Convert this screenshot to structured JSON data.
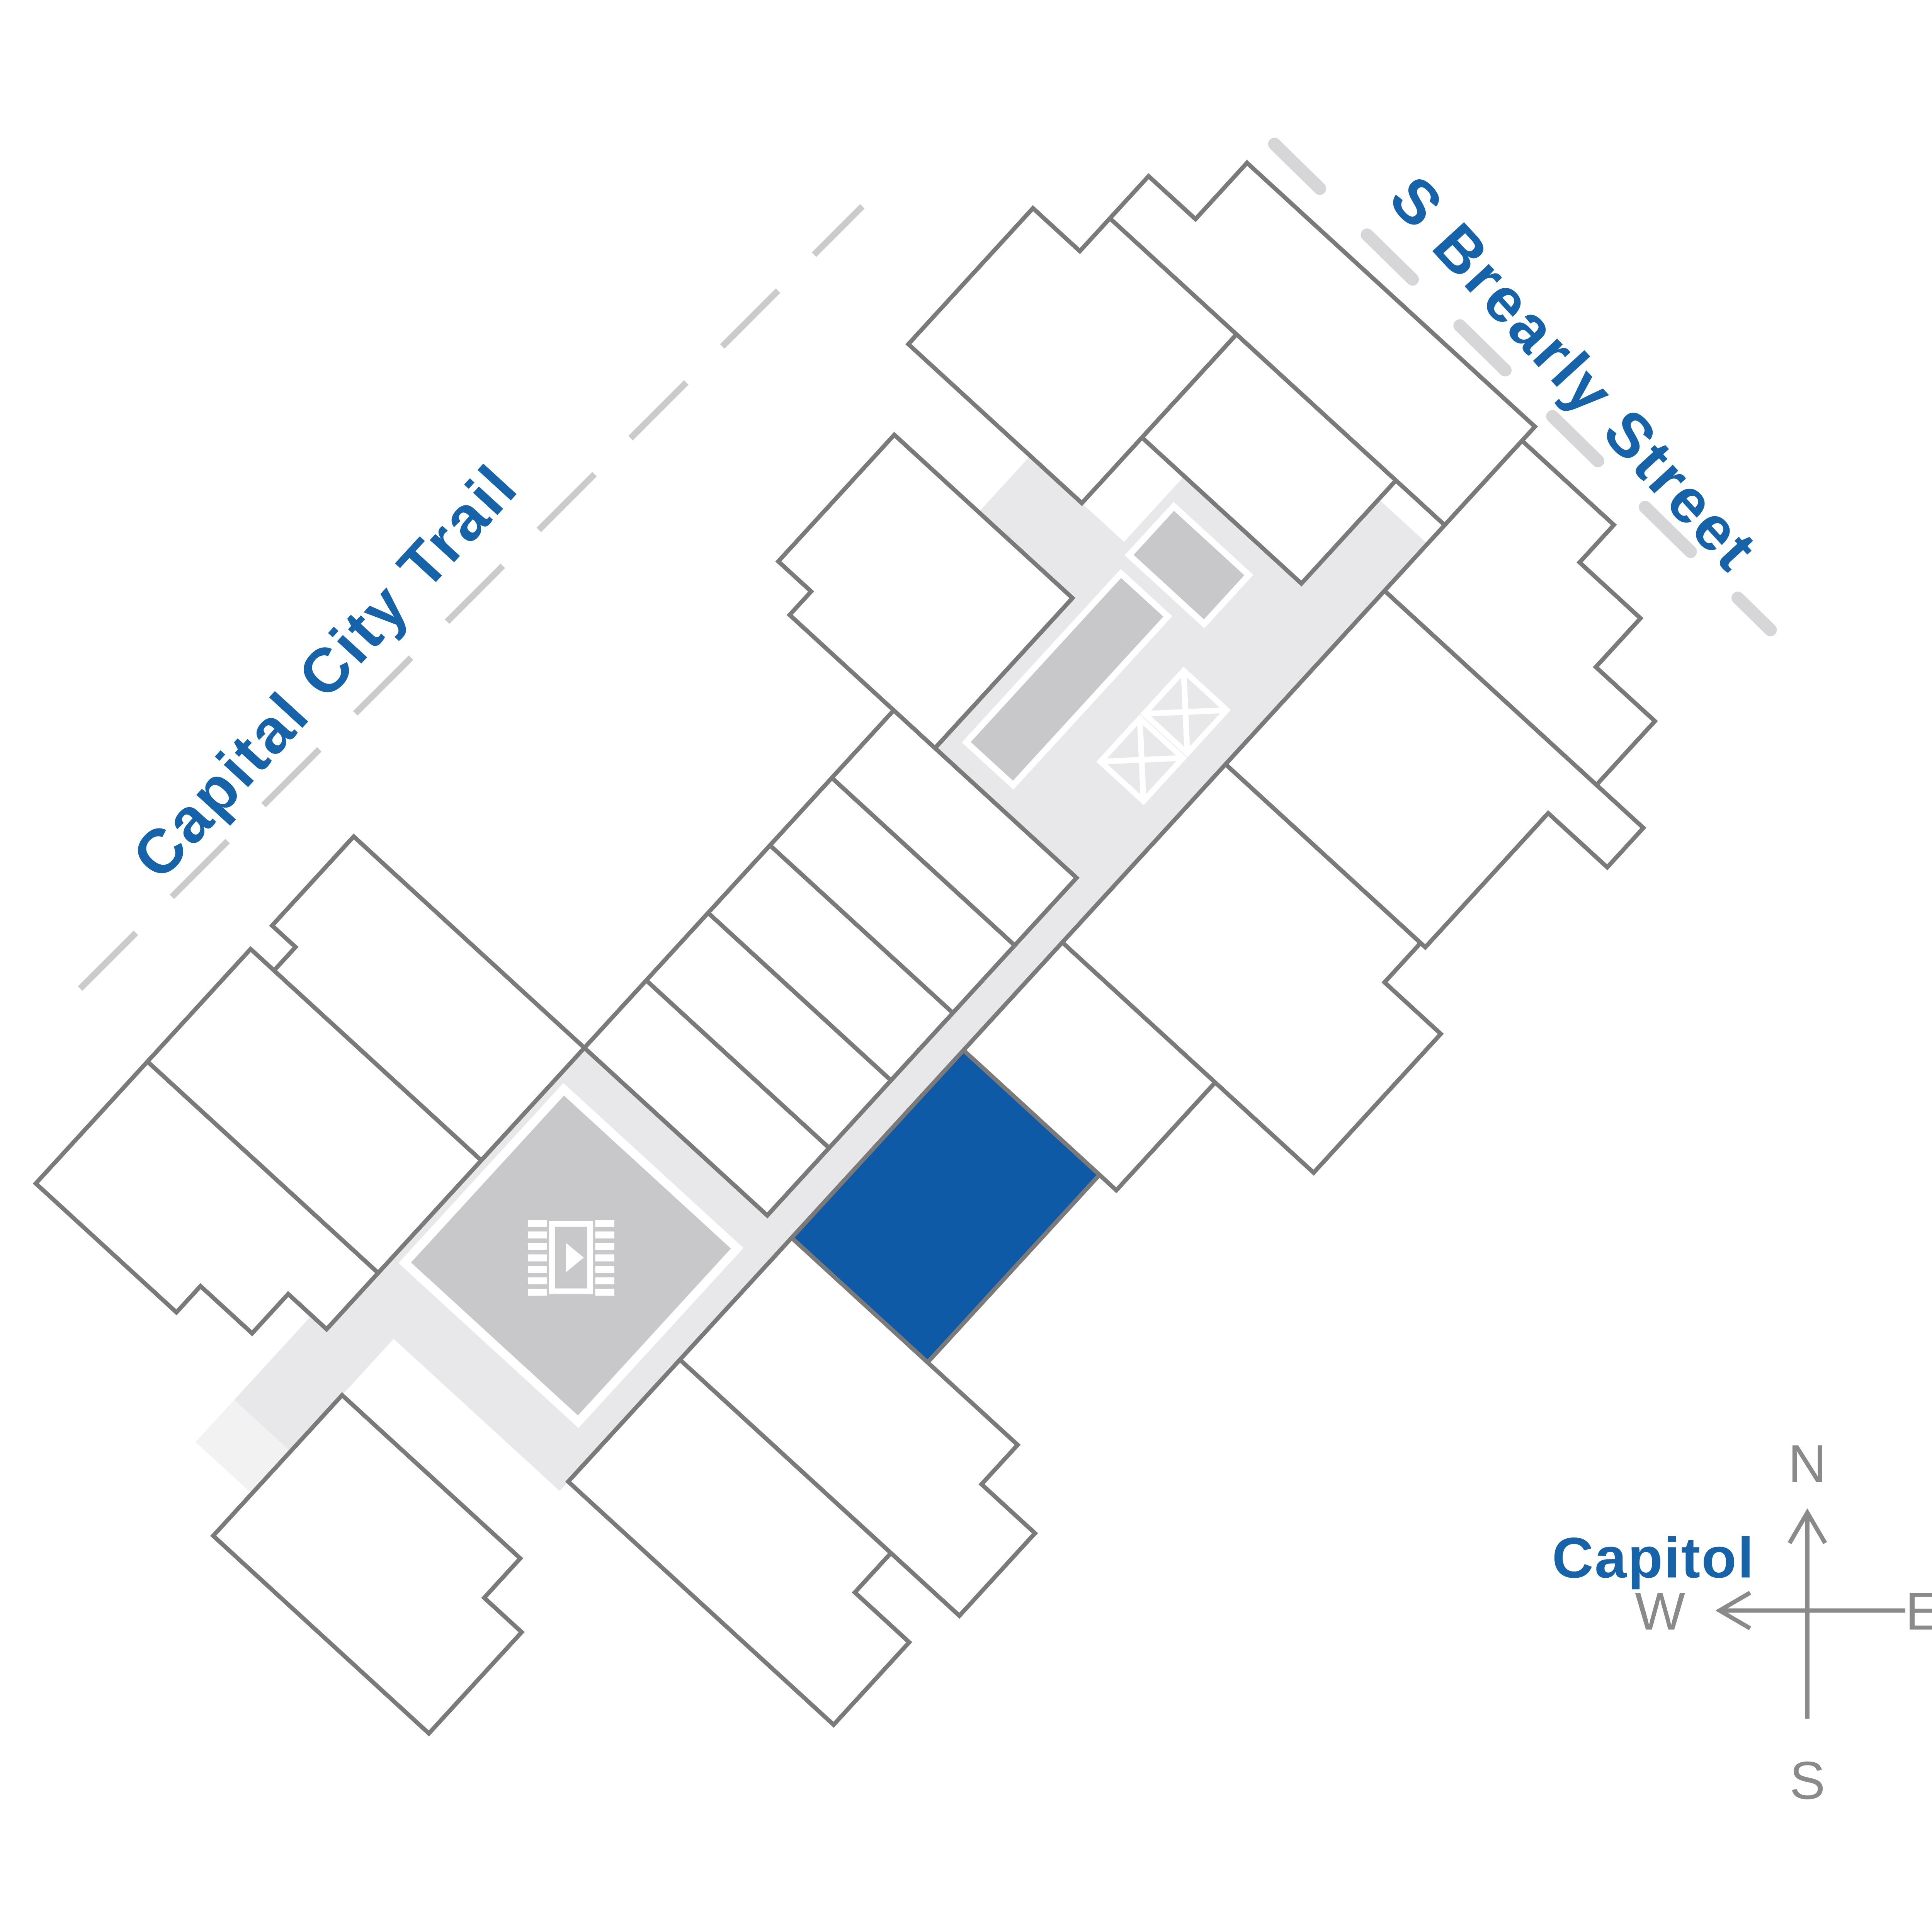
{
  "map": {
    "title": "Community site plan with selected unit",
    "streets": {
      "trail": {
        "label": "Capital City Trail"
      },
      "street": {
        "label": "S Brearly Street"
      }
    },
    "landmark": {
      "label": "Capitol"
    },
    "compass": {
      "north": "N",
      "south": "S",
      "east": "E",
      "west": "W"
    },
    "selected_unit": {
      "status": "highlighted",
      "color": "#0e5aa6"
    },
    "amenities": {
      "media_room_icon": "film-play-icon",
      "stair_icons": [
        "x-stair-icon",
        "x-stair-icon"
      ]
    },
    "colors": {
      "accent_blue": "#0e5aa6",
      "text_blue": "#1763a9",
      "corridor_gray": "#e8e8ea",
      "corridor_end_gray": "#f2f2f3",
      "amenity_gray": "#c8c8ca",
      "outline_gray": "#7a7a7a",
      "dash_gray": "#cccccc",
      "compass_gray": "#8a8a8a",
      "background": "#ffffff"
    }
  }
}
